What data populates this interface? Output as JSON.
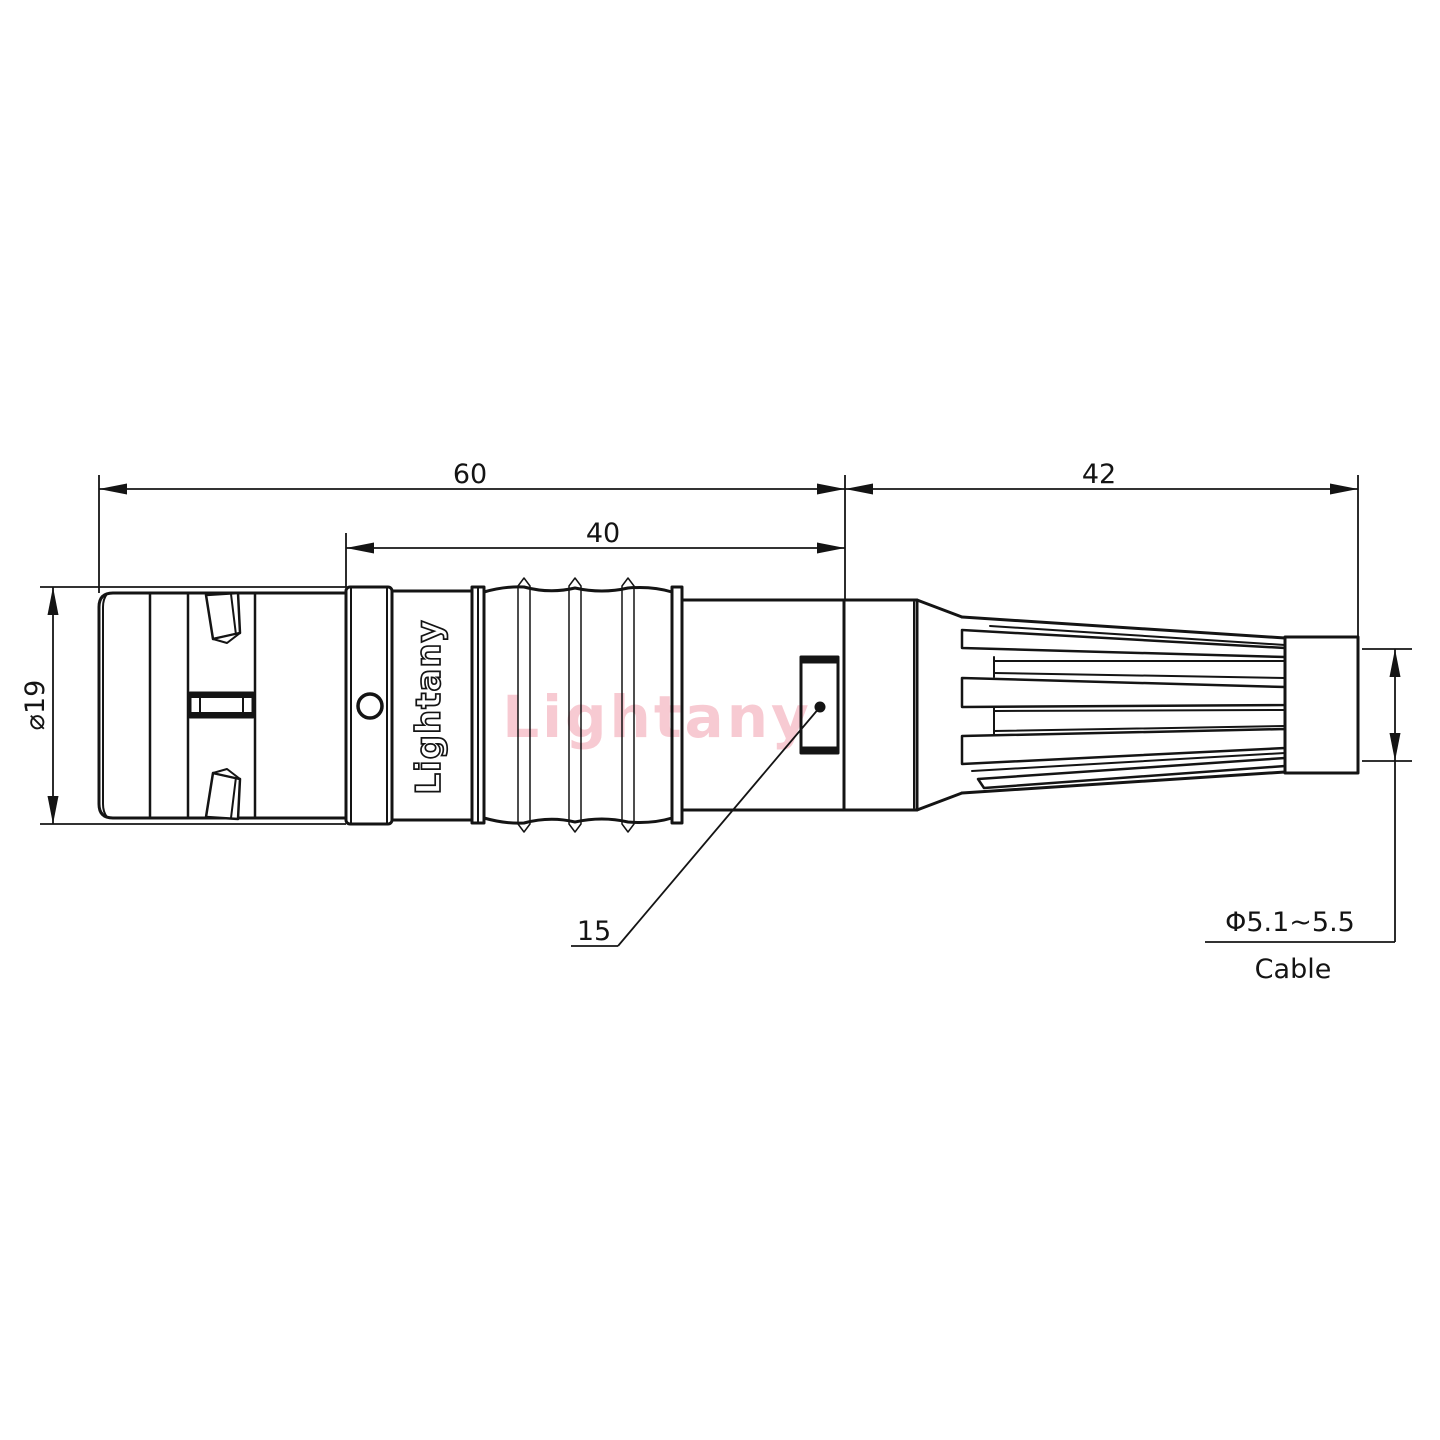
{
  "drawing": {
    "type": "connector-dimension-drawing",
    "dimensions": {
      "overall_length": "60",
      "body_length": "40",
      "boot_length": "42",
      "shell_diameter": "⌀19",
      "latch_ref": "15",
      "cable_diameter_range": "Φ5.1~5.5",
      "cable_word": "Cable"
    },
    "branding": {
      "barrel_engraving": "Lightany",
      "watermark": "Lightany"
    },
    "colors": {
      "line": "#141414",
      "watermark_red": "#e23a56",
      "background": "#ffffff"
    }
  }
}
